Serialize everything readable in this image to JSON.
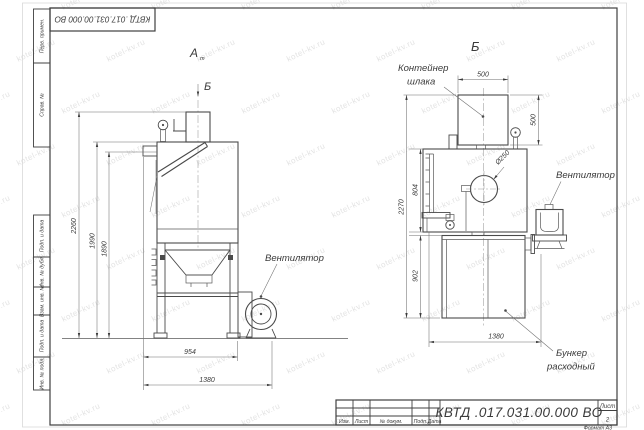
{
  "doc_code": "КВТД .017.031.00.000  ВО",
  "watermark_text": "kotel-kv.ru",
  "sheet": {
    "format_note": "Формат А3",
    "sheet_label": "Лист",
    "sheet_value": "2"
  },
  "stamp_labels": [
    "Изм.",
    "Лист",
    "№ докум.",
    "Подп.",
    "Дата"
  ],
  "sidebar_items": [
    "Перв. примен.",
    "Справ. №",
    "Подп. и дата",
    "Инв. № дубл.",
    "Взам. инв. №",
    "Подп. и дата",
    "Инв. № подл."
  ],
  "front_view": {
    "label_a": "А",
    "label_a_sub": "m",
    "label_b": "Б",
    "fan_callout": "Вентилятор",
    "dim_total_h": "2260",
    "dim_mid_h": "1990",
    "dim_inner_h": "1890",
    "dim_body_w": "954",
    "dim_total_w": "1380"
  },
  "side_view": {
    "view_title": "Б",
    "slag_callout_line1": "Контейнер",
    "slag_callout_line2": "шлака",
    "fan_callout": "Вентилятор",
    "hopper_callout_line1": "Бункер",
    "hopper_callout_line2": "расходный",
    "dim_container_w": "500",
    "dim_container_h": "500",
    "dim_body_h": "804",
    "dim_total_h": "2270",
    "dim_hopper_h": "902",
    "dim_width": "1380",
    "dim_opening": "Ø250"
  }
}
